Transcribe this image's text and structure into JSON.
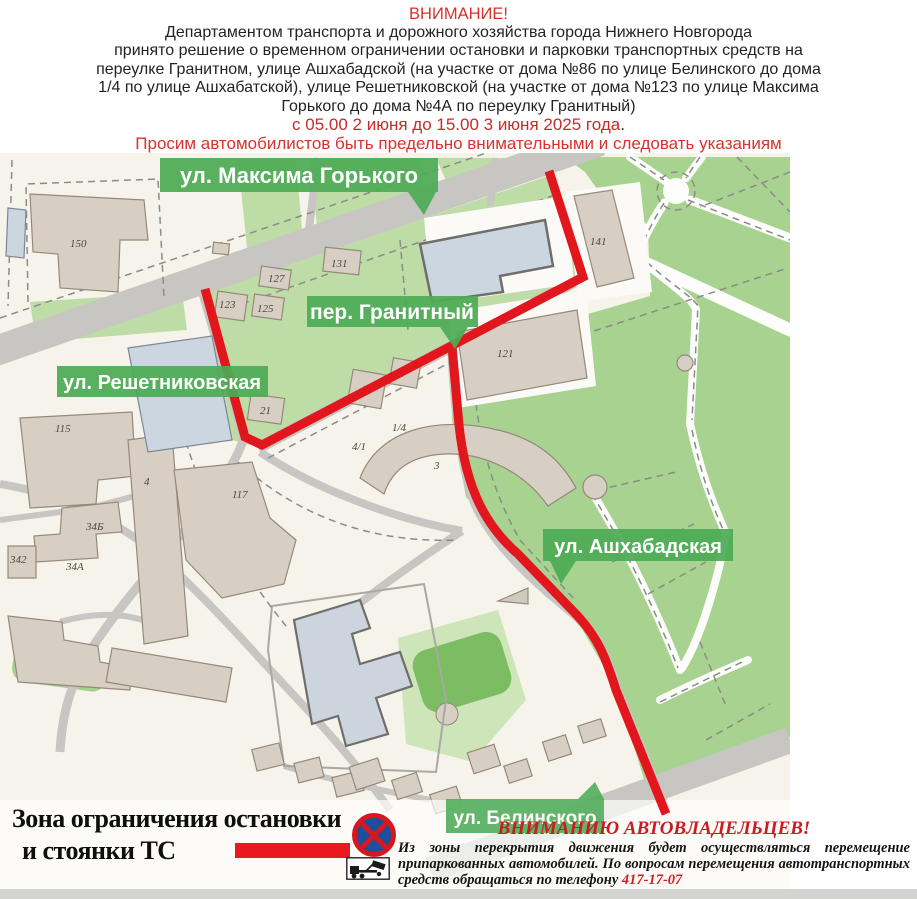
{
  "header": {
    "attention": "ВНИМАНИЕ!",
    "line1": "Департаментом транспорта и дорожного хозяйства города Нижнего Новгорода",
    "line2": "принято решение о временном ограничении остановки и парковки транспортных средств на",
    "line3": "переулке Гранитном, улице Ашхабадской (на участке от дома №86 по улице Белинского до дома",
    "line4": "1/4 по улице Ашхабатской), улице Решетниковской (на участке от дома №123 по улице Максима",
    "line5": "Горького до дома №4А по переулку Гранитный)",
    "date_line": "с 05.00  2 июня до 15.00 3 июня 2025 года",
    "date_period": ".",
    "plea_line": "Просим автомобилистов быть предельно внимательными и следовать указаниям"
  },
  "map": {
    "street_labels": [
      {
        "label": "ул. Максима Горького"
      },
      {
        "label": "пер. Гранитный"
      },
      {
        "label": "ул. Решетниковская"
      },
      {
        "label": "ул. Ашхабадская"
      },
      {
        "label": "ул. Белинского"
      }
    ],
    "building_numbers": [
      {
        "t": "150"
      },
      {
        "t": "131"
      },
      {
        "t": "127"
      },
      {
        "t": "123"
      },
      {
        "t": "125"
      },
      {
        "t": "141"
      },
      {
        "t": "121"
      },
      {
        "t": "9"
      },
      {
        "t": "7"
      },
      {
        "t": "21"
      },
      {
        "t": "1/4"
      },
      {
        "t": "4/1"
      },
      {
        "t": "3"
      },
      {
        "t": "115"
      },
      {
        "t": "4"
      },
      {
        "t": "117"
      },
      {
        "t": "34Б"
      },
      {
        "t": "342"
      },
      {
        "t": "34А"
      }
    ],
    "colors": {
      "route_red": "#e2171d",
      "badge_green": "#4cab55",
      "park_green": "#a8d290",
      "yard_green": "#bedda6",
      "road_gray": "#c7c6c3",
      "building_beige": "#d8cfc4"
    }
  },
  "legend": {
    "zone_line1": "Зона ограничения остановки",
    "zone_line2": "и стоянки ТС",
    "no_stopping_icon": "no-stopping-sign",
    "tow_icon": "tow-truck-icon",
    "notice_title": "ВНИМАНИЮ АВТОВЛАДЕЛЬЦЕВ!",
    "notice_line1": "Из зоны перекрытия движения будет осуществляться перемещение",
    "notice_line2": "припаркованных автомобилей. По вопросам перемещения автотранспортных",
    "notice_line3": "средств обращаться по телефону ",
    "phone": "417-17-07"
  }
}
